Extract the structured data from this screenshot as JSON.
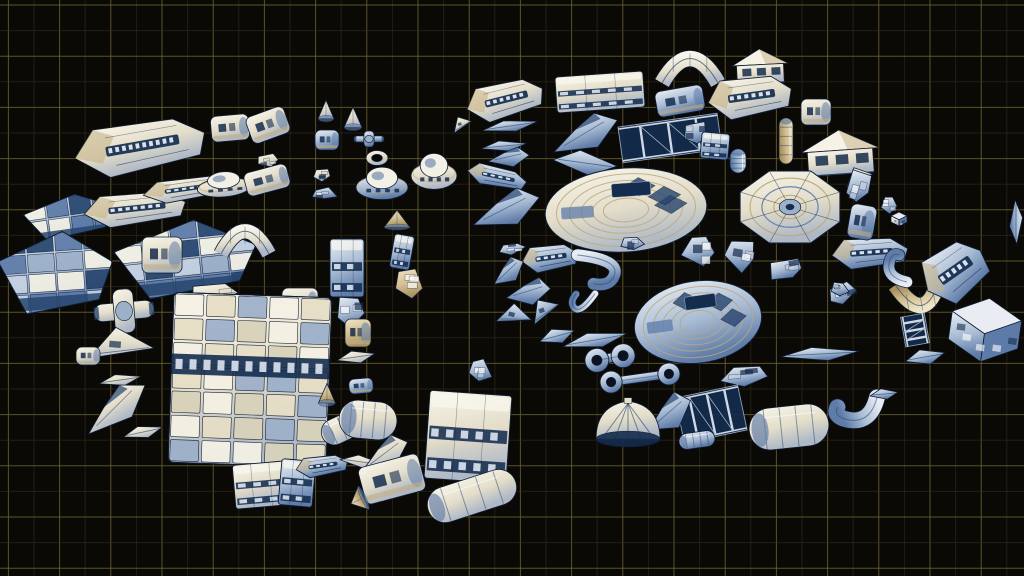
{
  "scene": {
    "description": "Sprite sheet of modular sci-fi spaceship 3D parts floating over a dark blueprint grid, arranged in two loose clusters",
    "canvas": {
      "width": 1024,
      "height": 576
    },
    "background": "#0a0906",
    "grid": {
      "minor_spacing": 25.6,
      "major_spacing": 51.2,
      "offset_x": 8.4,
      "offset_y": 5,
      "minor_color": "#37321a",
      "major_color": "#6a6130",
      "minor_opacity": 0.55,
      "major_opacity": 0.85
    },
    "palette": {
      "white": "#f4f1e4",
      "cream": "#e6dec6",
      "tan": "#c3ae82",
      "blue_light": "#9db0ca",
      "blue_mid": "#5d7ba8",
      "navy": "#27456e",
      "deep": "#142c4e",
      "ink": "#0f1d33",
      "hole": "#0b1322"
    },
    "clusters": [
      {
        "name": "left-cluster",
        "bounds": [
          40,
          95,
          520,
          520
        ]
      },
      {
        "name": "right-cluster",
        "bounds": [
          470,
          40,
          1024,
          520
        ]
      }
    ],
    "parts": [
      {
        "t": "hull",
        "x": 140,
        "y": 147,
        "w": 132,
        "h": 50,
        "r": -10,
        "c": "w"
      },
      {
        "t": "pod",
        "x": 230,
        "y": 128,
        "w": 38,
        "h": 26,
        "r": -5,
        "c": "w"
      },
      {
        "t": "pod",
        "x": 268,
        "y": 125,
        "w": 40,
        "h": 28,
        "r": -20,
        "c": "w"
      },
      {
        "t": "frag",
        "x": 268,
        "y": 160,
        "w": 28,
        "h": 16,
        "r": -10,
        "c": "w"
      },
      {
        "t": "cone",
        "x": 326,
        "y": 112,
        "w": 16,
        "h": 24,
        "r": 0,
        "c": "w"
      },
      {
        "t": "pod",
        "x": 327,
        "y": 140,
        "w": 24,
        "h": 20,
        "r": 0,
        "c": "b"
      },
      {
        "t": "cone",
        "x": 353,
        "y": 120,
        "w": 18,
        "h": 26,
        "r": 0,
        "c": "w"
      },
      {
        "t": "cross",
        "x": 369,
        "y": 139,
        "w": 30,
        "h": 16,
        "r": 0,
        "c": "b"
      },
      {
        "t": "ring",
        "x": 377,
        "y": 158,
        "w": 22,
        "h": 15,
        "r": 0,
        "c": "w"
      },
      {
        "t": "saucer",
        "x": 382,
        "y": 183,
        "w": 52,
        "h": 36,
        "r": 0,
        "c": "b"
      },
      {
        "t": "saucer",
        "x": 434,
        "y": 171,
        "w": 46,
        "h": 40,
        "r": 0,
        "c": "w"
      },
      {
        "t": "wedge",
        "x": 462,
        "y": 124,
        "w": 20,
        "h": 16,
        "r": -15,
        "c": "w"
      },
      {
        "t": "plate",
        "x": 70,
        "y": 216,
        "w": 92,
        "h": 42,
        "r": -8,
        "c": "b"
      },
      {
        "t": "hull",
        "x": 135,
        "y": 209,
        "w": 102,
        "h": 32,
        "r": -6,
        "c": "w"
      },
      {
        "t": "hull",
        "x": 188,
        "y": 189,
        "w": 90,
        "h": 22,
        "r": -8,
        "c": "w"
      },
      {
        "t": "saucer",
        "x": 224,
        "y": 184,
        "w": 54,
        "h": 28,
        "r": -5,
        "c": "w"
      },
      {
        "t": "pod",
        "x": 267,
        "y": 180,
        "w": 44,
        "h": 24,
        "r": -15,
        "c": "w"
      },
      {
        "t": "frag",
        "x": 322,
        "y": 174,
        "w": 28,
        "h": 18,
        "r": 0,
        "c": "w"
      },
      {
        "t": "frag",
        "x": 324,
        "y": 194,
        "w": 30,
        "h": 15,
        "r": 0,
        "c": "b"
      },
      {
        "t": "plate",
        "x": 56,
        "y": 272,
        "w": 114,
        "h": 80,
        "r": -4,
        "c": "b"
      },
      {
        "t": "plate",
        "x": 186,
        "y": 258,
        "w": 142,
        "h": 74,
        "r": -6,
        "c": "b"
      },
      {
        "t": "arch",
        "x": 245,
        "y": 241,
        "w": 48,
        "h": 26,
        "r": 0,
        "c": "w"
      },
      {
        "t": "pod",
        "x": 162,
        "y": 255,
        "w": 40,
        "h": 36,
        "r": 0,
        "c": "w"
      },
      {
        "t": "box",
        "x": 347,
        "y": 268,
        "w": 34,
        "h": 58,
        "r": 0,
        "c": "b"
      },
      {
        "t": "box",
        "x": 402,
        "y": 252,
        "w": 20,
        "h": 34,
        "r": 10,
        "c": "b"
      },
      {
        "t": "frag",
        "x": 408,
        "y": 283,
        "w": 45,
        "h": 33,
        "r": 0,
        "c": "t"
      },
      {
        "t": "cone",
        "x": 397,
        "y": 221,
        "w": 26,
        "h": 22,
        "r": 0,
        "c": "t"
      },
      {
        "t": "cross",
        "x": 124,
        "y": 311,
        "w": 60,
        "h": 44,
        "r": -5,
        "c": "w"
      },
      {
        "t": "wedge",
        "x": 122,
        "y": 346,
        "w": 64,
        "h": 36,
        "r": 5,
        "c": "w"
      },
      {
        "t": "pod",
        "x": 88,
        "y": 356,
        "w": 24,
        "h": 18,
        "r": 0,
        "c": "w"
      },
      {
        "t": "blade",
        "x": 120,
        "y": 380,
        "w": 42,
        "h": 12,
        "r": -8,
        "c": "w"
      },
      {
        "t": "wing",
        "x": 115,
        "y": 406,
        "w": 72,
        "h": 34,
        "r": -25,
        "c": "w"
      },
      {
        "t": "blade",
        "x": 143,
        "y": 432,
        "w": 40,
        "h": 13,
        "r": -12,
        "c": "w"
      },
      {
        "t": "frag",
        "x": 215,
        "y": 294,
        "w": 56,
        "h": 30,
        "r": -5,
        "c": "w"
      },
      {
        "t": "pod",
        "x": 300,
        "y": 302,
        "w": 36,
        "h": 28,
        "r": 0,
        "c": "w"
      },
      {
        "t": "block",
        "x": 250,
        "y": 380,
        "w": 158,
        "h": 170,
        "r": 2,
        "c": "w"
      },
      {
        "t": "frag",
        "x": 351,
        "y": 312,
        "w": 38,
        "h": 40,
        "r": 0,
        "c": "b"
      },
      {
        "t": "pod",
        "x": 358,
        "y": 333,
        "w": 26,
        "h": 28,
        "r": 0,
        "c": "t"
      },
      {
        "t": "blade",
        "x": 356,
        "y": 357,
        "w": 38,
        "h": 13,
        "r": -8,
        "c": "w"
      },
      {
        "t": "pod",
        "x": 361,
        "y": 386,
        "w": 24,
        "h": 15,
        "r": -5,
        "c": "b"
      },
      {
        "t": "cone",
        "x": 327,
        "y": 396,
        "w": 17,
        "h": 25,
        "r": 0,
        "c": "t"
      },
      {
        "t": "cyl",
        "x": 347,
        "y": 426,
        "w": 54,
        "h": 26,
        "r": -25,
        "c": "w"
      },
      {
        "t": "box",
        "x": 261,
        "y": 485,
        "w": 54,
        "h": 44,
        "r": -5,
        "c": "w"
      },
      {
        "t": "box",
        "x": 297,
        "y": 483,
        "w": 34,
        "h": 46,
        "r": 5,
        "c": "b"
      },
      {
        "t": "hull",
        "x": 322,
        "y": 466,
        "w": 52,
        "h": 20,
        "r": -8,
        "c": "b"
      },
      {
        "t": "blade",
        "x": 362,
        "y": 462,
        "w": 44,
        "h": 13,
        "r": 8,
        "c": "w"
      },
      {
        "t": "cyl",
        "x": 368,
        "y": 420,
        "w": 58,
        "h": 38,
        "r": 5,
        "c": "w"
      },
      {
        "t": "wing",
        "x": 385,
        "y": 452,
        "w": 48,
        "h": 32,
        "r": -10,
        "c": "w"
      },
      {
        "t": "pod",
        "x": 392,
        "y": 479,
        "w": 62,
        "h": 38,
        "r": -15,
        "c": "w"
      },
      {
        "t": "cone",
        "x": 359,
        "y": 500,
        "w": 26,
        "h": 18,
        "r": -115,
        "c": "t"
      },
      {
        "t": "box",
        "x": 468,
        "y": 437,
        "w": 82,
        "h": 88,
        "r": 4,
        "c": "w"
      },
      {
        "t": "cyl",
        "x": 472,
        "y": 496,
        "w": 92,
        "h": 36,
        "r": -18,
        "c": "w"
      },
      {
        "t": "hull",
        "x": 505,
        "y": 100,
        "w": 78,
        "h": 36,
        "r": -14,
        "c": "w"
      },
      {
        "t": "box",
        "x": 600,
        "y": 92,
        "w": 88,
        "h": 36,
        "r": -4,
        "c": "w"
      },
      {
        "t": "arch",
        "x": 690,
        "y": 69,
        "w": 56,
        "h": 28,
        "r": 0,
        "c": "w"
      },
      {
        "t": "pod",
        "x": 680,
        "y": 101,
        "w": 48,
        "h": 26,
        "r": -10,
        "c": "b"
      },
      {
        "t": "house",
        "x": 760,
        "y": 66,
        "w": 56,
        "h": 34,
        "r": -3,
        "c": "w"
      },
      {
        "t": "hull",
        "x": 750,
        "y": 97,
        "w": 84,
        "h": 40,
        "r": -8,
        "c": "w"
      },
      {
        "t": "blade",
        "x": 510,
        "y": 126,
        "w": 56,
        "h": 12,
        "r": -8,
        "c": "b"
      },
      {
        "t": "blade",
        "x": 504,
        "y": 146,
        "w": 46,
        "h": 11,
        "r": -5,
        "c": "b"
      },
      {
        "t": "wing",
        "x": 509,
        "y": 156,
        "w": 40,
        "h": 20,
        "r": 8,
        "c": "b"
      },
      {
        "t": "wing",
        "x": 585,
        "y": 132,
        "w": 68,
        "h": 34,
        "r": -10,
        "c": "b"
      },
      {
        "t": "blade",
        "x": 585,
        "y": 163,
        "w": 64,
        "h": 24,
        "r": 8,
        "c": "b"
      },
      {
        "t": "hull",
        "x": 497,
        "y": 177,
        "w": 60,
        "h": 20,
        "r": 12,
        "c": "b"
      },
      {
        "t": "truss",
        "x": 670,
        "y": 138,
        "w": 100,
        "h": 36,
        "r": -8,
        "c": "b"
      },
      {
        "t": "pod",
        "x": 816,
        "y": 112,
        "w": 30,
        "h": 26,
        "r": 0,
        "c": "w"
      },
      {
        "t": "cyl",
        "x": 786,
        "y": 141,
        "w": 46,
        "h": 14,
        "r": 90,
        "c": "t"
      },
      {
        "t": "frag",
        "x": 695,
        "y": 133,
        "w": 32,
        "h": 30,
        "r": 0,
        "c": "b"
      },
      {
        "t": "box",
        "x": 715,
        "y": 146,
        "w": 28,
        "h": 26,
        "r": 5,
        "c": "b"
      },
      {
        "t": "cyl",
        "x": 738,
        "y": 161,
        "w": 24,
        "h": 16,
        "r": 90,
        "c": "b"
      },
      {
        "t": "house",
        "x": 840,
        "y": 152,
        "w": 78,
        "h": 44,
        "r": -4,
        "c": "w"
      },
      {
        "t": "wedge",
        "x": 859,
        "y": 177,
        "w": 28,
        "h": 20,
        "r": -10,
        "c": "w"
      },
      {
        "t": "dish",
        "x": 790,
        "y": 207,
        "w": 108,
        "h": 78,
        "r": 0,
        "c": "w"
      },
      {
        "t": "ribsaucer",
        "x": 626,
        "y": 210,
        "w": 162,
        "h": 84,
        "r": -4,
        "c": "w"
      },
      {
        "t": "ribsaucer",
        "x": 698,
        "y": 322,
        "w": 128,
        "h": 82,
        "r": -8,
        "c": "b"
      },
      {
        "t": "wing",
        "x": 506,
        "y": 207,
        "w": 68,
        "h": 36,
        "r": -5,
        "c": "b"
      },
      {
        "t": "frag",
        "x": 512,
        "y": 248,
        "w": 34,
        "h": 14,
        "r": -5,
        "c": "b"
      },
      {
        "t": "hull",
        "x": 550,
        "y": 258,
        "w": 56,
        "h": 26,
        "r": -8,
        "c": "b"
      },
      {
        "t": "wing",
        "x": 508,
        "y": 270,
        "w": 34,
        "h": 24,
        "r": -15,
        "c": "b"
      },
      {
        "t": "wing",
        "x": 529,
        "y": 290,
        "w": 42,
        "h": 28,
        "r": 10,
        "c": "b"
      },
      {
        "t": "wedge",
        "x": 515,
        "y": 316,
        "w": 34,
        "h": 24,
        "r": 15,
        "c": "b"
      },
      {
        "t": "wedge",
        "x": 545,
        "y": 310,
        "w": 30,
        "h": 24,
        "r": -20,
        "c": "b"
      },
      {
        "t": "hook",
        "x": 598,
        "y": 271,
        "w": 46,
        "h": 32,
        "r": 0,
        "c": "b"
      },
      {
        "t": "hook",
        "x": 581,
        "y": 300,
        "w": 28,
        "h": 18,
        "r": 120,
        "c": "b"
      },
      {
        "t": "blade",
        "x": 557,
        "y": 336,
        "w": 36,
        "h": 16,
        "r": -15,
        "c": "b"
      },
      {
        "t": "blade",
        "x": 595,
        "y": 340,
        "w": 65,
        "h": 16,
        "r": -10,
        "c": "b"
      },
      {
        "t": "frag",
        "x": 632,
        "y": 243,
        "w": 30,
        "h": 20,
        "r": 0,
        "c": "b"
      },
      {
        "t": "dumbbell",
        "x": 610,
        "y": 358,
        "w": 50,
        "h": 26,
        "r": -10,
        "c": "b"
      },
      {
        "t": "dumbbell",
        "x": 640,
        "y": 378,
        "w": 80,
        "h": 24,
        "r": -8,
        "c": "b"
      },
      {
        "t": "frag",
        "x": 700,
        "y": 250,
        "w": 40,
        "h": 44,
        "r": 0,
        "c": "b"
      },
      {
        "t": "frag",
        "x": 740,
        "y": 255,
        "w": 40,
        "h": 40,
        "r": 10,
        "c": "b"
      },
      {
        "t": "frag",
        "x": 787,
        "y": 269,
        "w": 44,
        "h": 28,
        "r": -10,
        "c": "b"
      },
      {
        "t": "frag",
        "x": 843,
        "y": 292,
        "w": 44,
        "h": 28,
        "r": -15,
        "c": "b"
      },
      {
        "t": "arch",
        "x": 920,
        "y": 295,
        "w": 45,
        "h": 28,
        "r": 170,
        "c": "t"
      },
      {
        "t": "truss",
        "x": 915,
        "y": 330,
        "w": 30,
        "h": 24,
        "r": 80,
        "c": "b"
      },
      {
        "t": "blade",
        "x": 925,
        "y": 357,
        "w": 40,
        "h": 16,
        "r": -10,
        "c": "b"
      },
      {
        "t": "blade",
        "x": 820,
        "y": 354,
        "w": 78,
        "h": 14,
        "r": -3,
        "c": "b"
      },
      {
        "t": "frag",
        "x": 745,
        "y": 376,
        "w": 56,
        "h": 24,
        "r": -5,
        "c": "b"
      },
      {
        "t": "frag",
        "x": 840,
        "y": 290,
        "w": 24,
        "h": 18,
        "r": 0,
        "c": "b"
      },
      {
        "t": "hull",
        "x": 870,
        "y": 253,
        "w": 76,
        "h": 30,
        "r": -4,
        "c": "b"
      },
      {
        "t": "hook",
        "x": 897,
        "y": 267,
        "w": 22,
        "h": 30,
        "r": 180,
        "c": "b"
      },
      {
        "t": "frag",
        "x": 860,
        "y": 186,
        "w": 30,
        "h": 44,
        "r": 15,
        "c": "b"
      },
      {
        "t": "frag",
        "x": 889,
        "y": 204,
        "w": 26,
        "h": 22,
        "r": 0,
        "c": "b"
      },
      {
        "t": "cube",
        "x": 899,
        "y": 219,
        "w": 16,
        "h": 14,
        "r": 0,
        "c": "w"
      },
      {
        "t": "pod",
        "x": 862,
        "y": 222,
        "w": 26,
        "h": 34,
        "r": 10,
        "c": "b"
      },
      {
        "t": "hull",
        "x": 955,
        "y": 272,
        "w": 66,
        "h": 54,
        "r": -35,
        "c": "b"
      },
      {
        "t": "cube",
        "x": 985,
        "y": 330,
        "w": 70,
        "h": 64,
        "r": 8,
        "c": "b"
      },
      {
        "t": "blade",
        "x": 1016,
        "y": 222,
        "w": 44,
        "h": 13,
        "r": 90,
        "c": "b"
      },
      {
        "t": "truss",
        "x": 711,
        "y": 414,
        "w": 64,
        "h": 46,
        "r": -12,
        "c": "b"
      },
      {
        "t": "cyl",
        "x": 697,
        "y": 440,
        "w": 36,
        "h": 16,
        "r": -8,
        "c": "b"
      },
      {
        "t": "cyl",
        "x": 789,
        "y": 427,
        "w": 80,
        "h": 42,
        "r": -6,
        "c": "w"
      },
      {
        "t": "hook",
        "x": 855,
        "y": 410,
        "w": 28,
        "h": 44,
        "r": 90,
        "c": "b"
      },
      {
        "t": "blade",
        "x": 884,
        "y": 394,
        "w": 28,
        "h": 11,
        "r": -5,
        "c": "b"
      },
      {
        "t": "wing",
        "x": 669,
        "y": 411,
        "w": 46,
        "h": 36,
        "r": -10,
        "c": "b"
      },
      {
        "t": "dome",
        "x": 628,
        "y": 429,
        "w": 64,
        "h": 56,
        "r": 0,
        "c": "w"
      },
      {
        "t": "frag",
        "x": 480,
        "y": 370,
        "w": 28,
        "h": 34,
        "r": 0,
        "c": "b"
      }
    ]
  }
}
